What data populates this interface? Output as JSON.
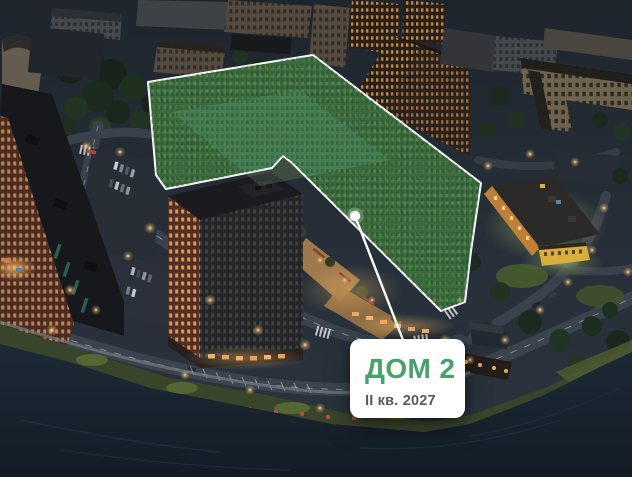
{
  "card": {
    "title": "ДОМ 2",
    "subtitle": "II кв. 2027"
  },
  "icons": {
    "marker": "location-marker-dot"
  },
  "theme": {
    "accent": "#47A36A",
    "subtitleColor": "#565C61",
    "cardBg": "#FFFFFF",
    "highlightFill": "rgba(62,158,84,0.55)",
    "highlightOutline": "#FFFFFF",
    "markerColor": "#FFFFFF"
  }
}
